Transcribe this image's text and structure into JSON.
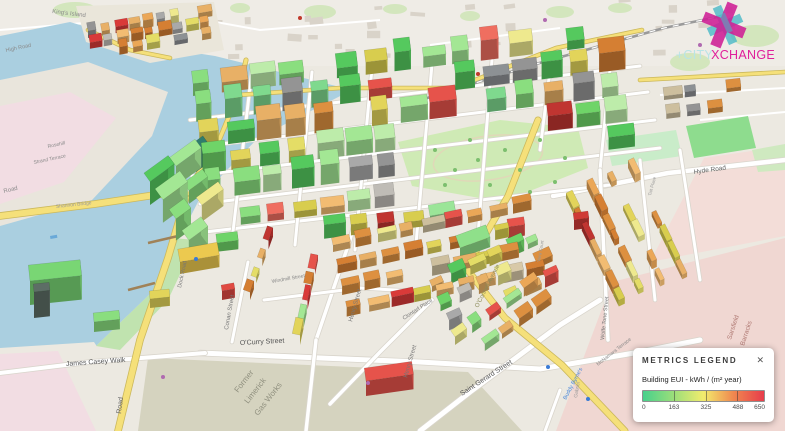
{
  "logo": {
    "prefix": "+CITY",
    "suffix": "XCHANGE",
    "colors": {
      "prefix": "#b9e4e6",
      "suffix": "#e01f9b",
      "magenta": "#cf1f96",
      "cyan": "#49b9c7"
    }
  },
  "legend": {
    "title": "METRICS LEGEND",
    "close": "✕",
    "metric": "Building EUI - kWh / (m² year)",
    "ticks": [
      "0",
      "163",
      "325",
      "488",
      "650"
    ],
    "gradient": [
      "#47d08c",
      "#9ade7a",
      "#f2ec6d",
      "#f0874f",
      "#e73c4b"
    ]
  },
  "map": {
    "area_colors": {
      "water": "#aacfe0",
      "land": "#ece9e1",
      "park": "#cfeab5",
      "residential_pink": "#f2dde3",
      "barracks_pink": "#f0d7d2",
      "gasworks": "#d5d3bf",
      "road_yellow": "#f5e07a"
    },
    "building_palette": {
      "green": [
        "#6fd468",
        "#8ade7f",
        "#a3e794",
        "#55c95e",
        "#bdecaa",
        "#7fd98e"
      ],
      "yellow": [
        "#e4dd66",
        "#d8cd4e",
        "#eee98e",
        "#e2d45a"
      ],
      "orange": [
        "#eba757",
        "#dd9040",
        "#f2bc72",
        "#d57f33",
        "#e8b066"
      ],
      "red": [
        "#e6534b",
        "#d93a39",
        "#ef6e60",
        "#c03531"
      ],
      "gray": [
        "#a9a9a9",
        "#949494",
        "#bfbcb6",
        "#8d9194"
      ],
      "tan": [
        "#d8c9a8",
        "#cdbf9e"
      ]
    },
    "labels": [
      {
        "t": "King's Island",
        "x": 52,
        "y": 13,
        "r": 7,
        "s": 6,
        "c": "#8a8a8a"
      },
      {
        "t": "High Road",
        "x": 6,
        "y": 52,
        "r": -12,
        "s": 5.5,
        "c": "#8a8a8a"
      },
      {
        "t": "Rosehill",
        "x": 48,
        "y": 148,
        "r": -12,
        "s": 5,
        "c": "#8a8a8a"
      },
      {
        "t": "Strand Terrace",
        "x": 34,
        "y": 164,
        "r": -12,
        "s": 5,
        "c": "#8a8a8a"
      },
      {
        "t": "Road",
        "x": 4,
        "y": 193,
        "r": -14,
        "s": 6,
        "c": "#8a8a8a"
      },
      {
        "t": "Shannon Bridge",
        "x": 56,
        "y": 208,
        "r": -6,
        "s": 5,
        "c": "#9a9a9a"
      },
      {
        "t": "Dock Road",
        "x": 181,
        "y": 288,
        "r": -78,
        "s": 5.5,
        "c": "#777777"
      },
      {
        "t": "Road",
        "x": 121,
        "y": 414,
        "r": -83,
        "s": 7,
        "c": "#666666"
      },
      {
        "t": "James Casey Walk",
        "x": 66,
        "y": 366,
        "r": -4,
        "s": 7,
        "c": "#555555"
      },
      {
        "t": "O'Curry Street",
        "x": 240,
        "y": 345,
        "r": -3,
        "s": 7,
        "c": "#555555"
      },
      {
        "t": "Conan Street",
        "x": 228,
        "y": 330,
        "r": -80,
        "s": 6,
        "c": "#777777"
      },
      {
        "t": "Windmill Street",
        "x": 272,
        "y": 283,
        "r": -10,
        "s": 5,
        "c": "#888888"
      },
      {
        "t": "Former",
        "x": 238,
        "y": 393,
        "r": -52,
        "s": 8,
        "c": "#90907f"
      },
      {
        "t": "Limerick",
        "x": 248,
        "y": 404,
        "r": -52,
        "s": 8,
        "c": "#90907f"
      },
      {
        "t": "Gas Works",
        "x": 258,
        "y": 416,
        "r": -52,
        "s": 8,
        "c": "#90907f"
      },
      {
        "t": "Henry Street",
        "x": 352,
        "y": 322,
        "r": -74,
        "s": 6,
        "c": "#777777"
      },
      {
        "t": "Henry Street",
        "x": 407,
        "y": 378,
        "r": -74,
        "s": 6,
        "c": "#777777"
      },
      {
        "t": "Clontarf Place",
        "x": 404,
        "y": 320,
        "r": -33,
        "s": 5.5,
        "c": "#777777"
      },
      {
        "t": "Saint Gerard Street",
        "x": 462,
        "y": 396,
        "r": -33,
        "s": 7,
        "c": "#555555"
      },
      {
        "t": "O'Connell Avenue",
        "x": 478,
        "y": 308,
        "r": -63,
        "s": 6,
        "c": "#8c8c5a"
      },
      {
        "t": "Wolfe Tone Street",
        "x": 604,
        "y": 340,
        "r": -84,
        "s": 5.5,
        "c": "#777777"
      },
      {
        "t": "McNamara Terrace",
        "x": 598,
        "y": 366,
        "r": -38,
        "s": 5,
        "c": "#888888"
      },
      {
        "t": "Buddy Byrne's",
        "x": 566,
        "y": 400,
        "r": -62,
        "s": 5.5,
        "c": "#4a86d8"
      },
      {
        "t": "Hyde Road",
        "x": 694,
        "y": 174,
        "r": -8,
        "s": 6.5,
        "c": "#666666"
      },
      {
        "t": "Sarsfield",
        "x": 731,
        "y": 340,
        "r": -72,
        "s": 6.5,
        "c": "#b07a74"
      },
      {
        "t": "Barracks",
        "x": 744,
        "y": 346,
        "r": -72,
        "s": 6.5,
        "c": "#b07a74"
      },
      {
        "t": "Gabriel",
        "x": 577,
        "y": 398,
        "r": -80,
        "s": 5,
        "c": "#999999"
      },
      {
        "t": "Vera Court",
        "x": 540,
        "y": 262,
        "r": -80,
        "s": 4.5,
        "c": "#999999"
      },
      {
        "t": "Tait Place",
        "x": 651,
        "y": 196,
        "r": -75,
        "s": 4.5,
        "c": "#999999"
      }
    ]
  }
}
